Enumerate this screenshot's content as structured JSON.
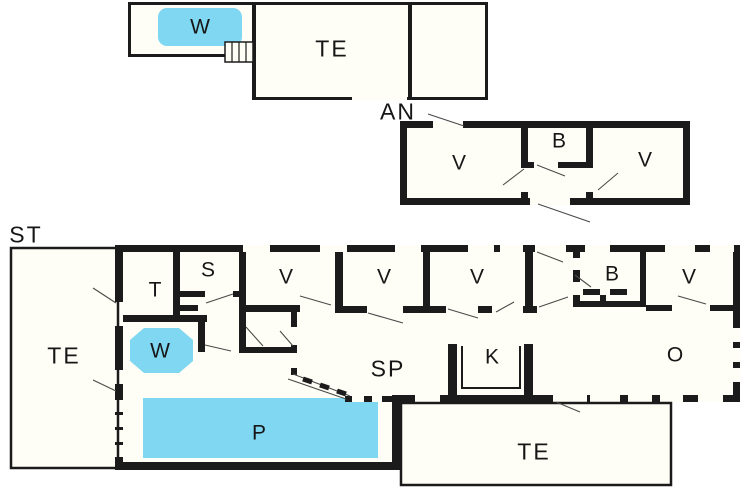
{
  "title": "cottage floor plan",
  "colors": {
    "wall": "#1b1b1b",
    "room_fill": "#fffef6",
    "water": "#7fd7f2",
    "swing_line": "#4a4a4a",
    "background": "#ffffff",
    "text": "#161616"
  },
  "buildings": {
    "main_house_tag": "ST",
    "annex_tag": "AN"
  },
  "labels": {
    "w_top": "W",
    "te_top": "TE",
    "an": "AN",
    "an_v1": "V",
    "an_b": "B",
    "an_v2": "V",
    "st": "ST",
    "te_left": "TE",
    "t": "T",
    "s": "S",
    "v1": "V",
    "v2": "V",
    "v3": "V",
    "b": "B",
    "v4": "V",
    "w": "W",
    "sp": "SP",
    "k": "K",
    "o": "O",
    "p": "P",
    "te_bottom": "TE"
  }
}
